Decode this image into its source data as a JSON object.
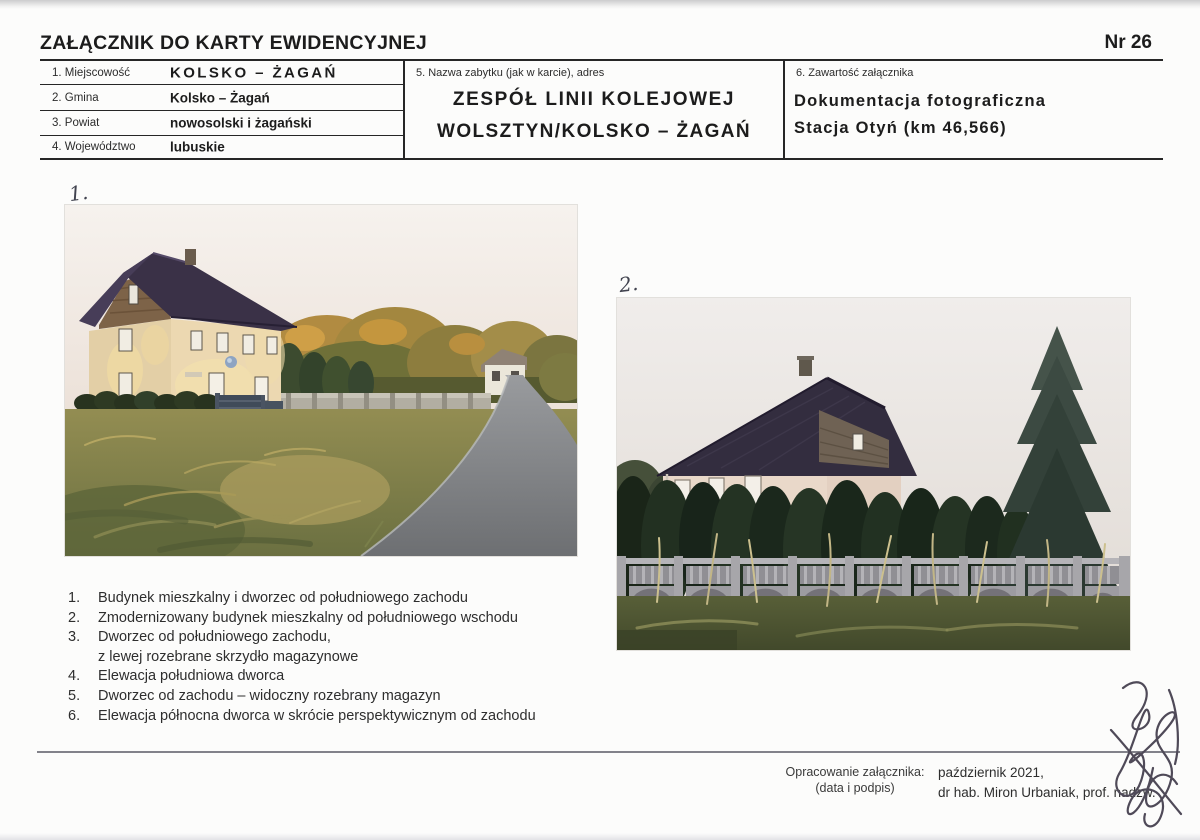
{
  "document": {
    "title": "ZAŁĄCZNIK DO KARTY EWIDENCYJNEJ",
    "number": "Nr 26"
  },
  "location_fields": [
    {
      "label": "1. Miejscowość",
      "value": "KOLSKO – ŻAGAŃ"
    },
    {
      "label": "2. Gmina",
      "value": "Kolsko – Żagań"
    },
    {
      "label": "3. Powiat",
      "value": "nowosolski i żagański"
    },
    {
      "label": "4. Województwo",
      "value": "lubuskie"
    }
  ],
  "monument": {
    "label": "5. Nazwa zabytku (jak w karcie), adres",
    "name_line1": "ZESPÓŁ LINII KOLEJOWEJ",
    "name_line2": "WOLSZTYN/KOLSKO – ŻAGAŃ"
  },
  "attachment_contents": {
    "label": "6. Zawartość załącznika",
    "line1": "Dokumentacja fotograficzna",
    "line2": "Stacja Otyń (km 46,566)"
  },
  "photos": [
    {
      "handwritten_number": "1."
    },
    {
      "handwritten_number": "2."
    }
  ],
  "captions": [
    {
      "num": "1.",
      "line1": "Budynek mieszkalny i dworzec od południowego zachodu",
      "line2": ""
    },
    {
      "num": "2.",
      "line1": "Zmodernizowany budynek mieszkalny od południowego wschodu",
      "line2": ""
    },
    {
      "num": "3.",
      "line1": "Dworzec od południowego zachodu,",
      "line2": "z lewej rozebrane skrzydło magazynowe"
    },
    {
      "num": "4.",
      "line1": "Elewacja południowa dworca",
      "line2": ""
    },
    {
      "num": "5.",
      "line1": "Dworzec od zachodu – widoczny rozebrany magazyn",
      "line2": ""
    },
    {
      "num": "6.",
      "line1": "Elewacja północna dworca w skrócie perspektywicznym od zachodu",
      "line2": ""
    }
  ],
  "footer": {
    "label_line1": "Opracowanie załącznika:",
    "label_line2": "(data i podpis)",
    "date_line": "październik 2021,",
    "author_line": "dr hab. Miron Urbaniak, prof. nadzw."
  }
}
